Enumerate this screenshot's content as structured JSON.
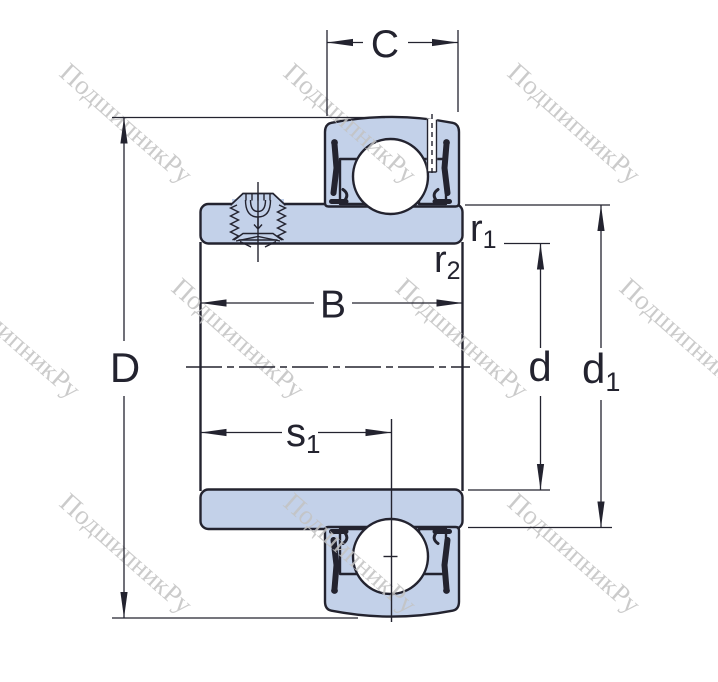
{
  "colors": {
    "line": "#23232f",
    "part-fill": "#c3d1e9",
    "watermark": "#c3c3c3",
    "background": "#ffffff"
  },
  "watermark": {
    "text": "ПодшипникРу"
  },
  "labels": {
    "C": "C",
    "D": "D",
    "B": "B",
    "d": "d",
    "d1": {
      "base": "d",
      "sub": "1"
    },
    "r1": {
      "base": "r",
      "sub": "1"
    },
    "r2": {
      "base": "r",
      "sub": "2"
    },
    "s1": {
      "base": "s",
      "sub": "1"
    }
  }
}
